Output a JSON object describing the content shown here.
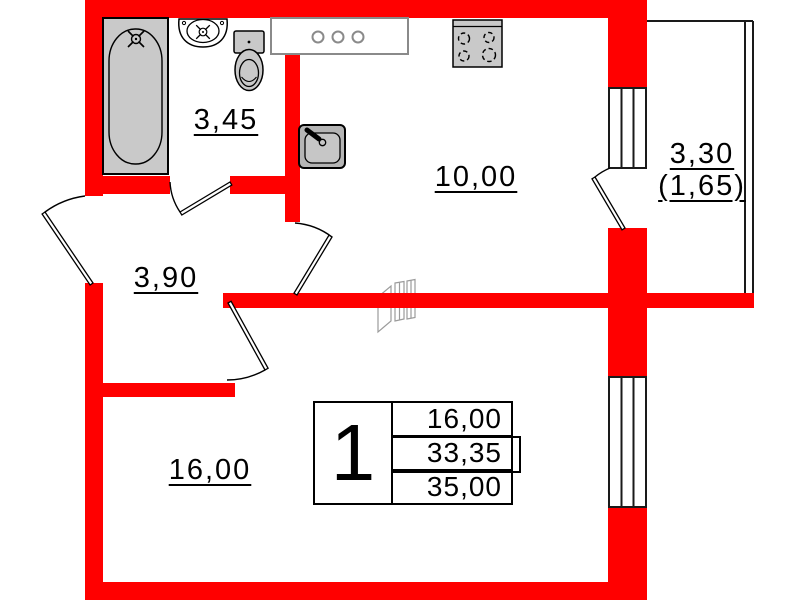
{
  "colors": {
    "wall_red": "#ff0000",
    "fixture_gray": "#c9c9c9",
    "counter_gray": "#8a8a8a",
    "line_black": "#000000"
  },
  "rooms": {
    "bathroom": {
      "label": "3,45"
    },
    "kitchen": {
      "label": "10,00"
    },
    "hallway": {
      "label": "3,90"
    },
    "living_room": {
      "label": "16,00"
    },
    "balcony": {
      "label": "3,30",
      "label_secondary": "(1,65)"
    }
  },
  "info_table": {
    "unit_number": "1",
    "values": [
      "16,00",
      "33,35",
      "35,00"
    ]
  },
  "icons": [
    "bathtub-icon",
    "washbasin-icon",
    "toilet-icon",
    "kitchen-counter-icon",
    "stove-icon",
    "kitchen-sink-icon",
    "vent-duct-icon",
    "window-icon",
    "door-swing-icon",
    "balcony-glazing-icon"
  ]
}
